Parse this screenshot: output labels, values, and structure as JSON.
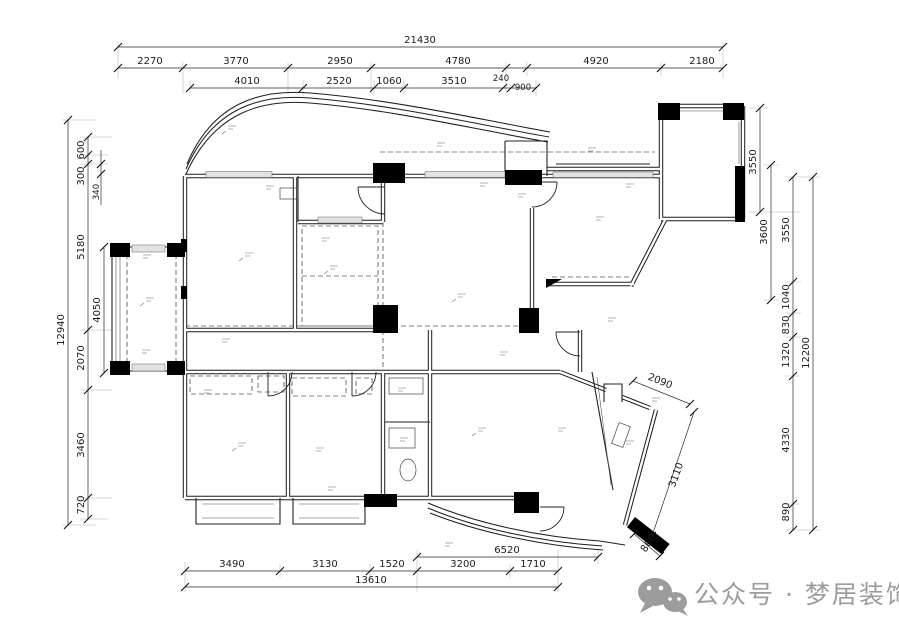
{
  "drawing": {
    "type": "residential floor plan",
    "colors": {
      "line": "#1a1a1a",
      "watermark": "#9c9c9c"
    }
  },
  "dimensions": {
    "top": {
      "total": "21430",
      "row1": [
        "2270",
        "3770",
        "2950",
        "4780",
        "4920",
        "2180"
      ],
      "row2": [
        "4010",
        "2520",
        "1060",
        "3510",
        "240",
        "900"
      ]
    },
    "left": {
      "total": "12940",
      "chain": [
        "600",
        "300",
        "5180",
        "2070",
        "3460",
        "720"
      ],
      "inner": [
        "340",
        "4050"
      ]
    },
    "right": {
      "total": "12200",
      "chain": [
        "3550",
        "1040",
        "830",
        "1320",
        "4330",
        "890"
      ],
      "inner": [
        "3550",
        "3600"
      ]
    },
    "bottom": {
      "total": "13610",
      "chain": [
        "3490",
        "3130",
        "1520",
        "3200",
        "1710"
      ],
      "upper": "6520",
      "angled": [
        "2090",
        "3110",
        "860"
      ]
    }
  },
  "watermark": {
    "icon": "wechat-icon",
    "text": "公众号 · 梦居装饰"
  }
}
